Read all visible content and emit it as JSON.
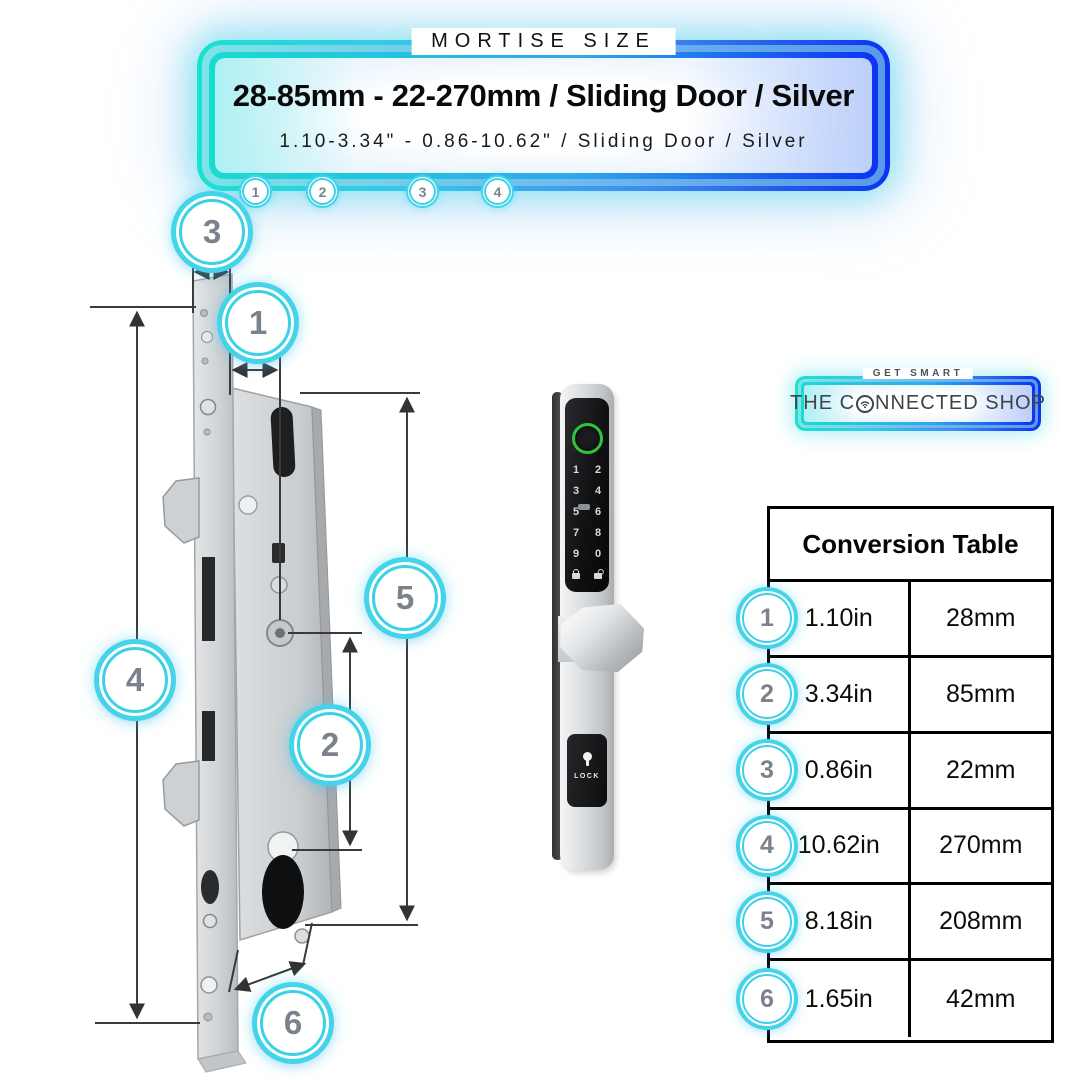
{
  "banner": {
    "eyebrow": "MORTISE SIZE",
    "title": "28-85mm - 22-270mm / Sliding Door / Silver",
    "subtitle": "1.10-3.34\" - 0.86-10.62\" / Sliding Door / Silver",
    "markers": [
      "1",
      "2",
      "3",
      "4"
    ]
  },
  "diagram": {
    "callouts": [
      "3",
      "1",
      "5",
      "4",
      "2",
      "6"
    ]
  },
  "smart_lock": {
    "keypad_digits": [
      "1",
      "2",
      "3",
      "4",
      "5",
      "6",
      "7",
      "8",
      "9",
      "0"
    ],
    "panel_label": "LOCK"
  },
  "logo": {
    "tagline": "GET SMART",
    "brand_prefix": "THE C",
    "brand_suffix": "NNECTED SHOP"
  },
  "conversion_table": {
    "title": "Conversion Table",
    "rows": [
      {
        "num": "1",
        "inches": "1.10in",
        "mm": "28mm"
      },
      {
        "num": "2",
        "inches": "3.34in",
        "mm": "85mm"
      },
      {
        "num": "3",
        "inches": "0.86in",
        "mm": "22mm"
      },
      {
        "num": "4",
        "inches": "10.62in",
        "mm": "270mm"
      },
      {
        "num": "5",
        "inches": "8.18in",
        "mm": "208mm"
      },
      {
        "num": "6",
        "inches": "1.65in",
        "mm": "42mm"
      }
    ]
  },
  "colors": {
    "accent_cyan": "#2fd9e2",
    "accent_blue": "#0c33f2",
    "ring_cyan": "#3bd2e8",
    "fingerprint_green": "#32c23c"
  }
}
